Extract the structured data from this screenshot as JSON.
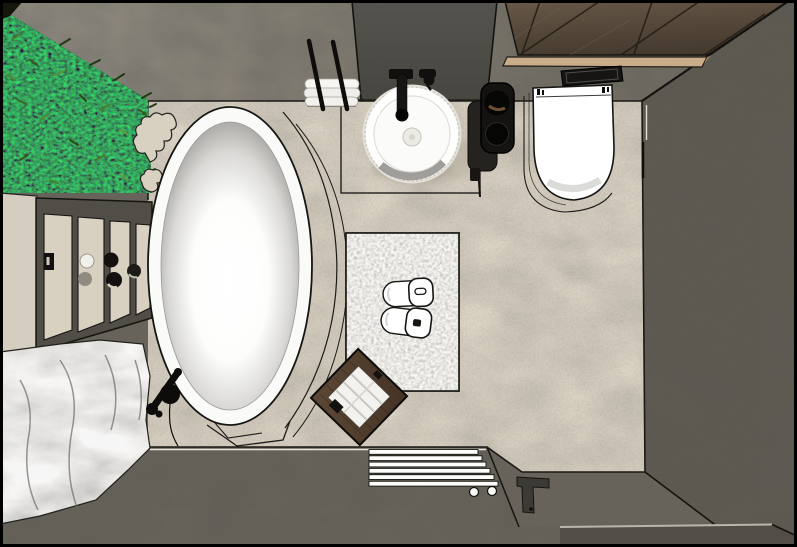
{
  "scene": {
    "type": "3d-interior-render",
    "view": "top-down-plan",
    "room": "bathroom"
  },
  "colors": {
    "outline": "#151412",
    "floor_beige": "#ddd5c6",
    "wall_top_left": "#8f8a80",
    "wall_top_right": "#6b665c",
    "wall_right": "#5e5a51",
    "wall_bottom": "#67635a",
    "wall_bottom_dark": "#524e47",
    "dark_panel": "#4a4843",
    "wood_dark": "#5b4e3f",
    "wood_trim": "#c9ad8a",
    "plant_base": "#121a0b",
    "plant_leaf": "#4d7c31",
    "rock_gray": "#aba79e",
    "stone_slab": "#d5cec0",
    "cabinet_frame": "#504e47",
    "fixture_white": "#ffffff",
    "fixture_black": "#161513",
    "tub_shade": "#8c8b87",
    "rug_base": "#d8d3ca",
    "stool_wood": "#55412f",
    "towel_white": "#f4f3f0",
    "highlight_line": "#f1eee6",
    "shadow_soft": "#b3ab9c"
  },
  "objects": {
    "bathtub": "freestanding-oval-bathtub",
    "tub_faucet": "black-floor-mounted-tub-filler",
    "basin": "round-vessel-washbasin",
    "basin_faucet": "black-wall-mounted-tap",
    "wall_unit": "black-wall-storage-unit",
    "toilet": "wall-hung-toilet",
    "flush_plate": "black-flush-plate",
    "towel_rack": "wall-towel-rack-with-rolled-towels",
    "rug": "textured-bath-mat",
    "slippers": "pair-of-white-slippers",
    "stool": "wooden-stool-with-folded-towels",
    "ladder": "white-towel-ladder",
    "plant_wall": "vertical-garden-wall",
    "rock": "decorative-boulder",
    "vanity": "stone-vanity-console",
    "wood_panel": "wood-slat-ceiling-panel"
  }
}
